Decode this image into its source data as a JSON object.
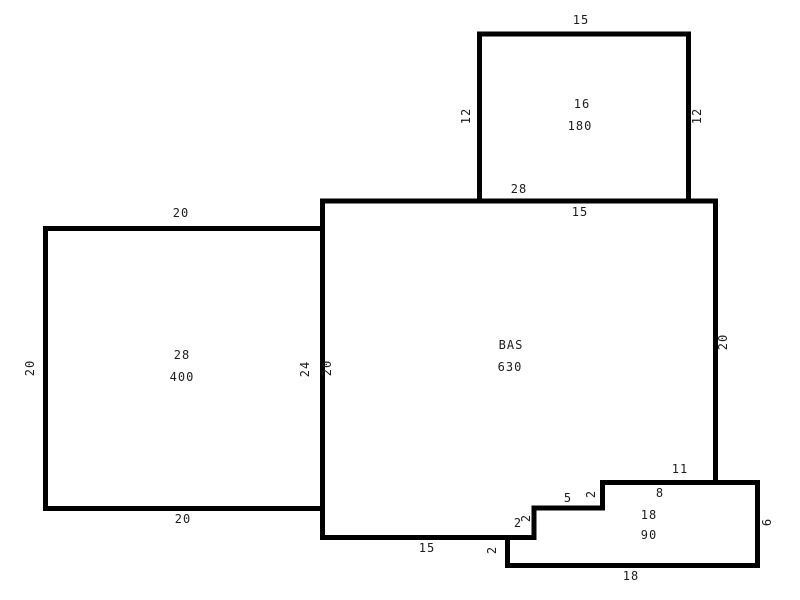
{
  "sketch": {
    "canvas": {
      "width": 800,
      "height": 600,
      "background": "#ffffff",
      "line_color": "#000000",
      "text_color": "#1c1c1c"
    },
    "rooms_summary": {
      "upper_room": {
        "label": "16",
        "area": "180"
      },
      "left_room": {
        "label": "28",
        "area": "400"
      },
      "main_room": {
        "label": "BAS",
        "area": "630"
      },
      "lower_right_room": {
        "labels": [
          "8",
          "18"
        ],
        "area": "90"
      }
    },
    "outlines": [
      {
        "name": "upper-room-outline",
        "d": "M 479.5,203 L 479.5,34 L 688.5,34 L 688.5,203"
      },
      {
        "name": "main-room-outline",
        "d": "M 715.5,482.5 L 715.5,201 L 322.5,201 L 322.5,537.5 L 510,537.5"
      },
      {
        "name": "left-room-outline",
        "d": "M 322.5,228.5 L 45.5,228.5 L 45.5,508.5 L 322.5,508.5"
      },
      {
        "name": "lower-right-room-outline",
        "d": "M 507.5,537.5 L 534,537.5 L 534,508 L 602.5,508 L 602.5,482.5 L 757.5,482.5 L 757.5,565.5 L 507.5,565.5 Z"
      }
    ],
    "labels": [
      {
        "name": "dim-upper-room-top-width",
        "text": "15",
        "x": 581,
        "y": 20,
        "rot": false
      },
      {
        "name": "dim-upper-room-left-height",
        "text": "12",
        "x": 466,
        "y": 116,
        "rot": true
      },
      {
        "name": "dim-upper-room-right-height",
        "text": "12",
        "x": 697,
        "y": 116,
        "rot": true
      },
      {
        "name": "upper-room-label",
        "text": "16",
        "x": 582,
        "y": 104,
        "rot": false
      },
      {
        "name": "upper-room-area",
        "text": "180",
        "x": 580,
        "y": 126,
        "rot": false
      },
      {
        "name": "dim-upper-room-bottom-width",
        "text": "28",
        "x": 519,
        "y": 189,
        "rot": false
      },
      {
        "name": "dim-main-room-top-width",
        "text": "15",
        "x": 580,
        "y": 212,
        "rot": false
      },
      {
        "name": "dim-left-room-top-width",
        "text": "20",
        "x": 181,
        "y": 213,
        "rot": false
      },
      {
        "name": "left-room-label",
        "text": "28",
        "x": 182,
        "y": 355,
        "rot": false
      },
      {
        "name": "left-room-area",
        "text": "400",
        "x": 182,
        "y": 377,
        "rot": false
      },
      {
        "name": "dim-left-room-left-height",
        "text": "20",
        "x": 30,
        "y": 368,
        "rot": true
      },
      {
        "name": "dim-left-room-right-height",
        "text": "24",
        "x": 305,
        "y": 369,
        "rot": true
      },
      {
        "name": "dim-main-room-left-height",
        "text": "20",
        "x": 327,
        "y": 368,
        "rot": true
      },
      {
        "name": "dim-left-room-bottom-width",
        "text": "20",
        "x": 183,
        "y": 519,
        "rot": false
      },
      {
        "name": "main-room-label",
        "text": "BAS",
        "x": 511,
        "y": 345,
        "rot": false
      },
      {
        "name": "main-room-area",
        "text": "630",
        "x": 510,
        "y": 367,
        "rot": false
      },
      {
        "name": "dim-main-room-right-height",
        "text": "20",
        "x": 723,
        "y": 342,
        "rot": true
      },
      {
        "name": "dim-main-room-bottom-width",
        "text": "15",
        "x": 427,
        "y": 548,
        "rot": false
      },
      {
        "name": "dim-step-upper-width",
        "text": "5",
        "x": 568,
        "y": 498,
        "rot": false
      },
      {
        "name": "dim-step-upper-height",
        "text": "2",
        "x": 591,
        "y": 494,
        "rot": true
      },
      {
        "name": "dim-step-middle-width",
        "text": "2",
        "x": 518,
        "y": 523,
        "rot": false
      },
      {
        "name": "dim-step-middle-height",
        "text": "2",
        "x": 526,
        "y": 518,
        "rot": true
      },
      {
        "name": "dim-step-lower-height",
        "text": "2",
        "x": 492,
        "y": 550,
        "rot": true
      },
      {
        "name": "dim-lower-room-top-width",
        "text": "11",
        "x": 680,
        "y": 469,
        "rot": false
      },
      {
        "name": "lower-room-label-a",
        "text": "8",
        "x": 660,
        "y": 493,
        "rot": false
      },
      {
        "name": "lower-room-label-b",
        "text": "18",
        "x": 649,
        "y": 515,
        "rot": false
      },
      {
        "name": "lower-room-area",
        "text": "90",
        "x": 649,
        "y": 535,
        "rot": false
      },
      {
        "name": "dim-lower-room-right-height",
        "text": "6",
        "x": 767,
        "y": 522,
        "rot": true
      },
      {
        "name": "dim-lower-room-bottom-width",
        "text": "18",
        "x": 631,
        "y": 576,
        "rot": false
      }
    ]
  }
}
